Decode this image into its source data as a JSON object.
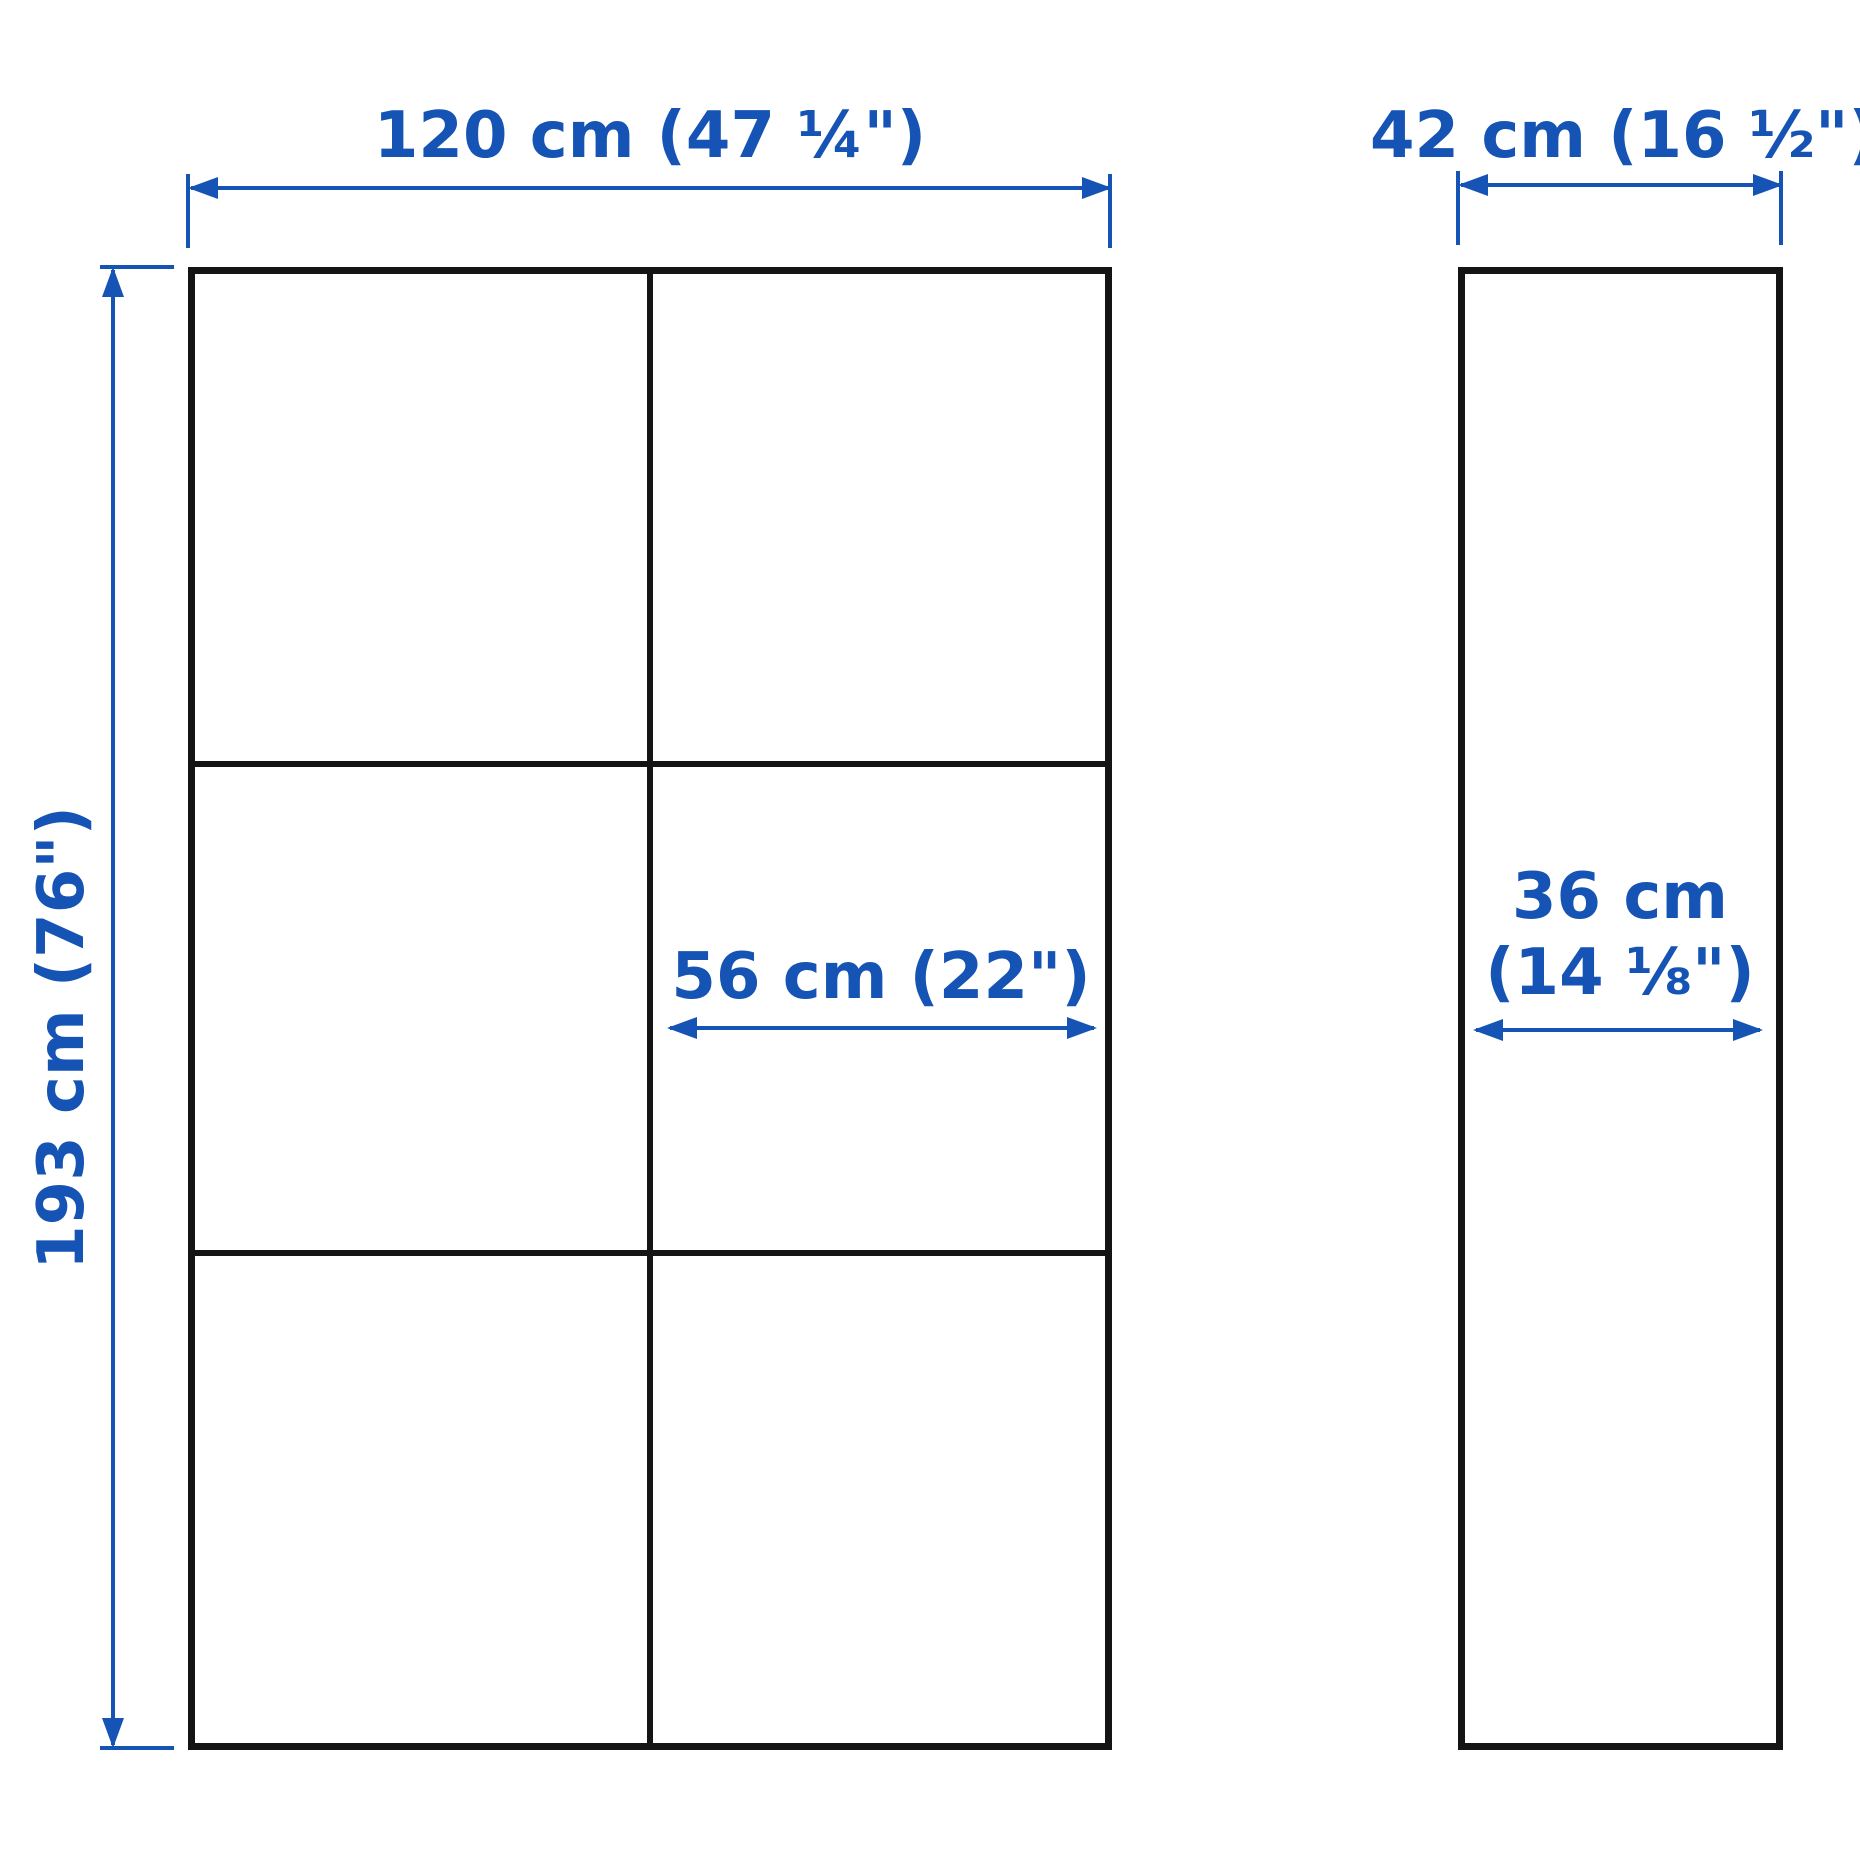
{
  "colors": {
    "dimension_blue": "#1553b4",
    "outline_black": "#141414",
    "background": "#ffffff"
  },
  "front_view": {
    "width_label": "120 cm (47 ¼\")",
    "height_label": "193 cm (76\")",
    "compartment_width_label": "56 cm (22\")",
    "columns": 2,
    "rows": 3
  },
  "side_view": {
    "depth_label": "42 cm (16 ½\")",
    "inner_depth_label_line1": "36 cm",
    "inner_depth_label_line2": "(14 ⅛\")"
  }
}
